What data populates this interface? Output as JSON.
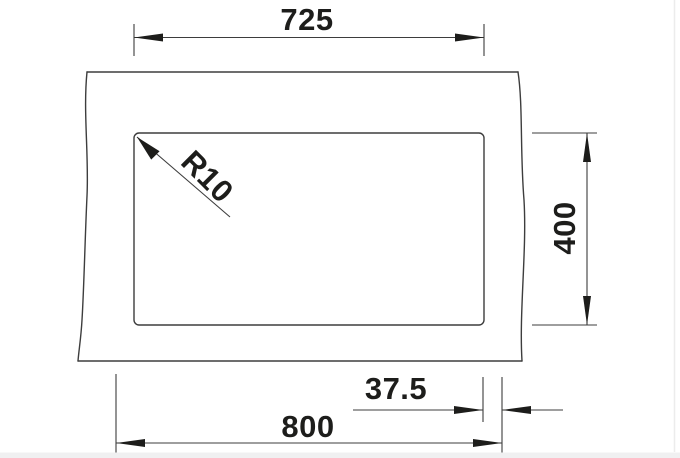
{
  "diagram": {
    "type": "technical-drawing",
    "subject": "sink-cutout-top-view",
    "labels": {
      "top_width": "725",
      "right_height": "400",
      "corner_radius": "R10",
      "bottom_offset": "37.5",
      "bottom_width": "800"
    },
    "colors": {
      "background": "#ffffff",
      "line": "#3d3d3d",
      "text": "#1d1d1b",
      "footer_strip": "#f0f0f1"
    }
  }
}
